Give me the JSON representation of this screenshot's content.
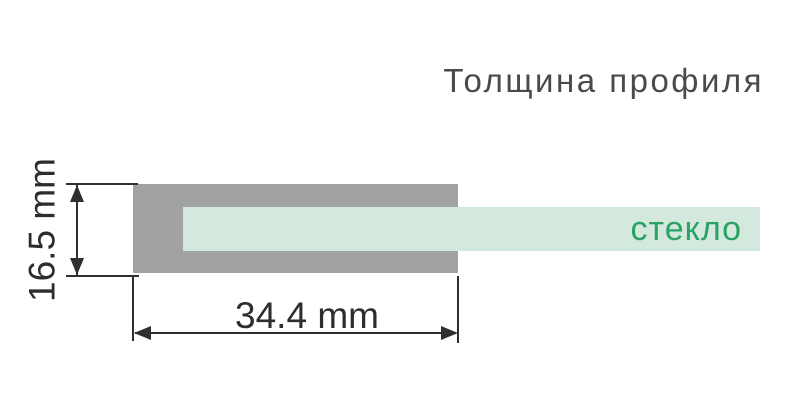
{
  "title": "Толщина профиля",
  "diagram": {
    "glass_label": "стекло",
    "dimensions": {
      "width": "34.4 mm",
      "height": "16.5 mm"
    },
    "colors": {
      "profile_gray": "#a0a3a1",
      "glass_mint": "#d3e9dd",
      "glass_label_green": "#2ba263",
      "dimension_dark": "#2f2f2f",
      "title_gray": "#4a4a4c"
    },
    "icons": [
      "arrow-up-icon",
      "arrow-down-icon",
      "arrow-left-icon",
      "arrow-right-icon"
    ]
  }
}
